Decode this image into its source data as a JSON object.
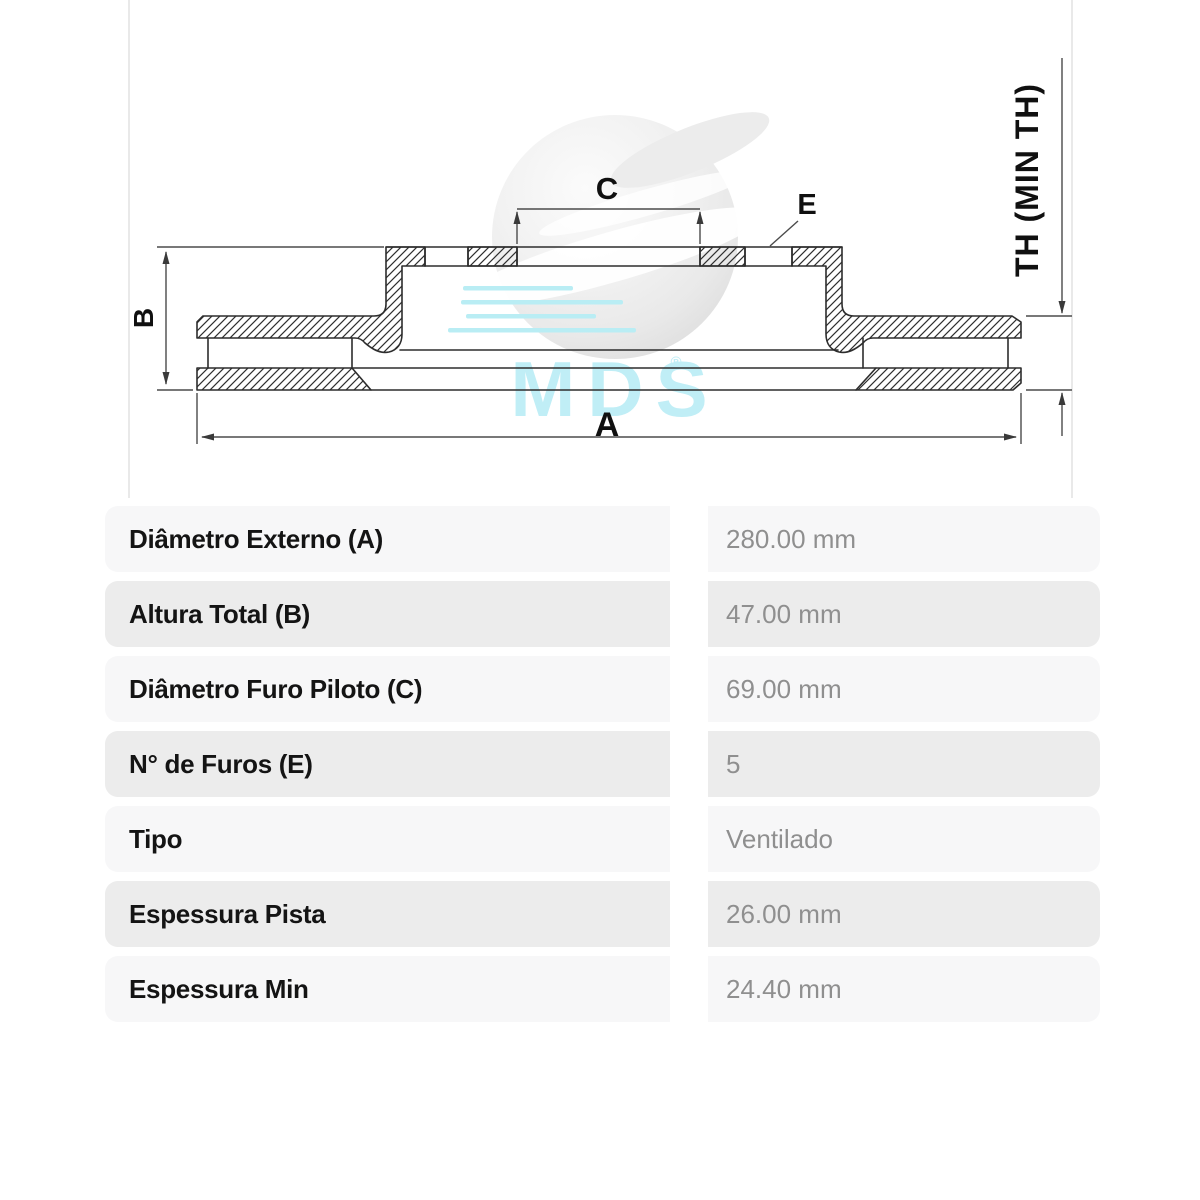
{
  "page": {
    "background": "#ffffff"
  },
  "image_panel": {
    "frame_color": "#e9e9e9",
    "watermark": {
      "text": "MDS",
      "registered_mark": "®",
      "accent_color": "#b9edf4",
      "sphere_color": "#ededed"
    },
    "diagram": {
      "type": "brake-disc cross-section technical drawing",
      "labels": {
        "a": "A",
        "b": "B",
        "c": "C",
        "e": "E",
        "th": "TH (MIN TH)"
      }
    }
  },
  "spec_table": {
    "row_colors": {
      "odd": "#f7f7f8",
      "even": "#ececec"
    },
    "label_color": "#141414",
    "value_color": "#8f8f8f",
    "rows": [
      {
        "label": "Diâmetro Externo (A)",
        "value": "280.00 mm"
      },
      {
        "label": "Altura Total (B)",
        "value": "47.00 mm"
      },
      {
        "label": "Diâmetro Furo Piloto (C)",
        "value": "69.00 mm"
      },
      {
        "label": "N° de Furos (E)",
        "value": "5"
      },
      {
        "label": "Tipo",
        "value": "Ventilado"
      },
      {
        "label": "Espessura Pista",
        "value": "26.00 mm"
      },
      {
        "label": "Espessura Min",
        "value": "24.40 mm"
      }
    ]
  }
}
